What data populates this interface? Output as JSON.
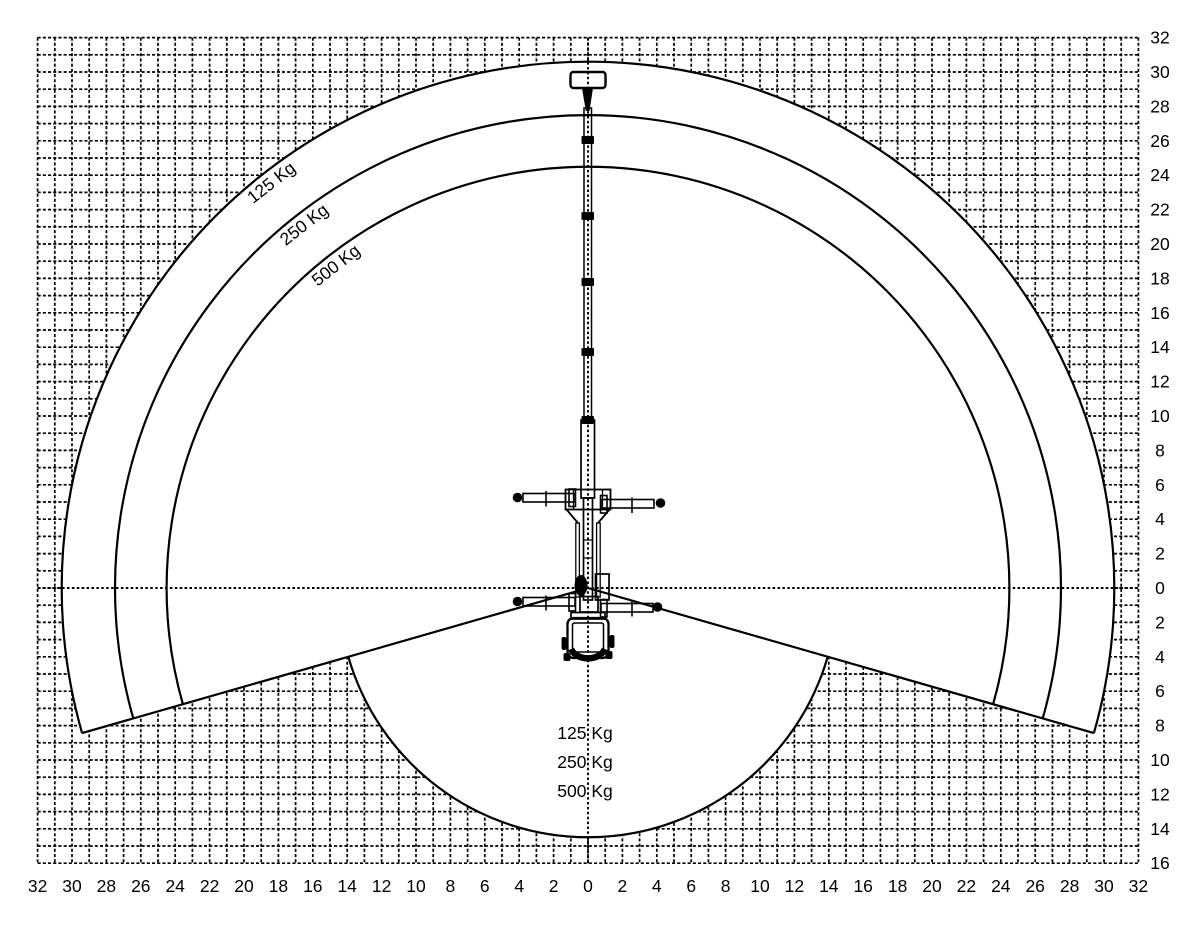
{
  "page": {
    "background": "#ffffff",
    "ink_color": "#000000"
  },
  "machine_icon": "truck-mounted-telescopic-platform-top-view",
  "chart_data": {
    "type": "line",
    "variant": "aerial-platform-working-envelope",
    "title": "",
    "grid": {
      "visible": true,
      "style": "dashed",
      "step_units": 1,
      "label_every_units": 2
    },
    "axes": {
      "x_range": [
        -32,
        32
      ],
      "y_range": [
        -16,
        32
      ],
      "x_tick_values": [
        -32,
        -30,
        -28,
        -26,
        -24,
        -22,
        -20,
        -18,
        -16,
        -14,
        -12,
        -10,
        -8,
        -6,
        -4,
        -2,
        0,
        2,
        4,
        6,
        8,
        10,
        12,
        14,
        16,
        18,
        20,
        22,
        24,
        26,
        28,
        30,
        32
      ],
      "x_tick_labels": [
        "32",
        "30",
        "28",
        "26",
        "24",
        "22",
        "20",
        "18",
        "16",
        "14",
        "12",
        "10",
        "8",
        "6",
        "4",
        "2",
        "0",
        "2",
        "4",
        "6",
        "8",
        "10",
        "12",
        "14",
        "16",
        "18",
        "20",
        "22",
        "24",
        "26",
        "28",
        "30",
        "32"
      ],
      "y_tick_values": [
        32,
        30,
        28,
        26,
        24,
        22,
        20,
        18,
        16,
        14,
        12,
        10,
        8,
        6,
        4,
        2,
        0,
        -2,
        -4,
        -6,
        -8,
        -10,
        -12,
        -14,
        -16
      ],
      "y_tick_labels": [
        "32",
        "30",
        "28",
        "26",
        "24",
        "22",
        "20",
        "18",
        "16",
        "14",
        "12",
        "10",
        "8",
        "6",
        "4",
        "2",
        "0",
        "2",
        "4",
        "6",
        "8",
        "10",
        "12",
        "14",
        "16"
      ]
    },
    "capacity_curves": [
      {
        "label": "125 Kg",
        "radius_units": 30.6
      },
      {
        "label": "250 Kg",
        "radius_units": 27.5
      },
      {
        "label": "500 Kg",
        "radius_units": 24.5
      }
    ],
    "below_center_circle_radius_units": 14.5,
    "boundary_ray_angle_below_horizontal_deg": 16,
    "curve_label_polar_angle_deg": 128,
    "curve_label_rotation_deg": -38,
    "center_legend_lines": [
      "125 Kg",
      "250 Kg",
      "500 Kg"
    ]
  }
}
